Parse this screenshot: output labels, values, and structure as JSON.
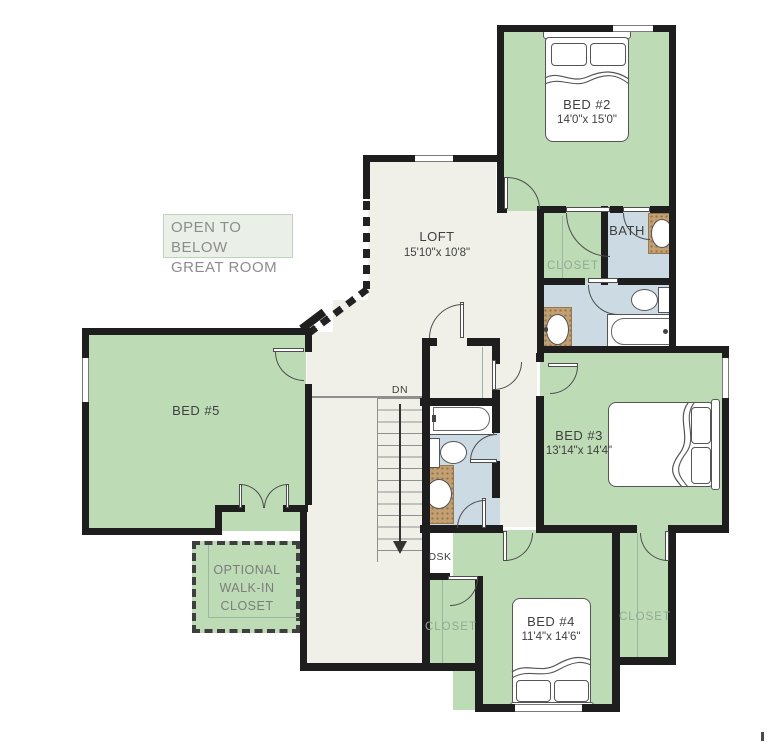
{
  "floorplan": {
    "type": "second-floor residential floor plan",
    "rooms": {
      "bed2": {
        "name": "BED #2",
        "dims": "14'0\"x 15'0\""
      },
      "bed3": {
        "name": "BED #3",
        "dims": "13'14\"x 14'4\""
      },
      "bed4": {
        "name": "BED #4",
        "dims": "11'4\"x 14'6\""
      },
      "bed5": {
        "name": "BED #5"
      },
      "loft": {
        "name": "LOFT",
        "dims": "15'10\"x 10'8\""
      },
      "bath": {
        "name": "BATH"
      },
      "closet_upper": {
        "name": "CLOSET"
      },
      "closet_bed4": {
        "name": "CLOSET"
      },
      "closet_bed3": {
        "name": "CLOSET"
      }
    },
    "annotations": {
      "open_to_below": {
        "line1": "OPEN TO BELOW",
        "line2": "GREAT ROOM"
      },
      "optional_closet": {
        "line1": "OPTIONAL",
        "line2": "WALK-IN",
        "line3": "CLOSET"
      },
      "desk": "DSK",
      "stairs_down": "DN"
    },
    "colors": {
      "wall": "#1e1e1e",
      "room_green": "#bddcb5",
      "bonus_cream": "#f0f0e9",
      "bath_blue": "#cbdae3",
      "counter_tan": "#c3a072",
      "label_dark": "#3f3f3f",
      "label_gray": "#8d8d8d",
      "label_green_gray": "#92a992"
    }
  }
}
